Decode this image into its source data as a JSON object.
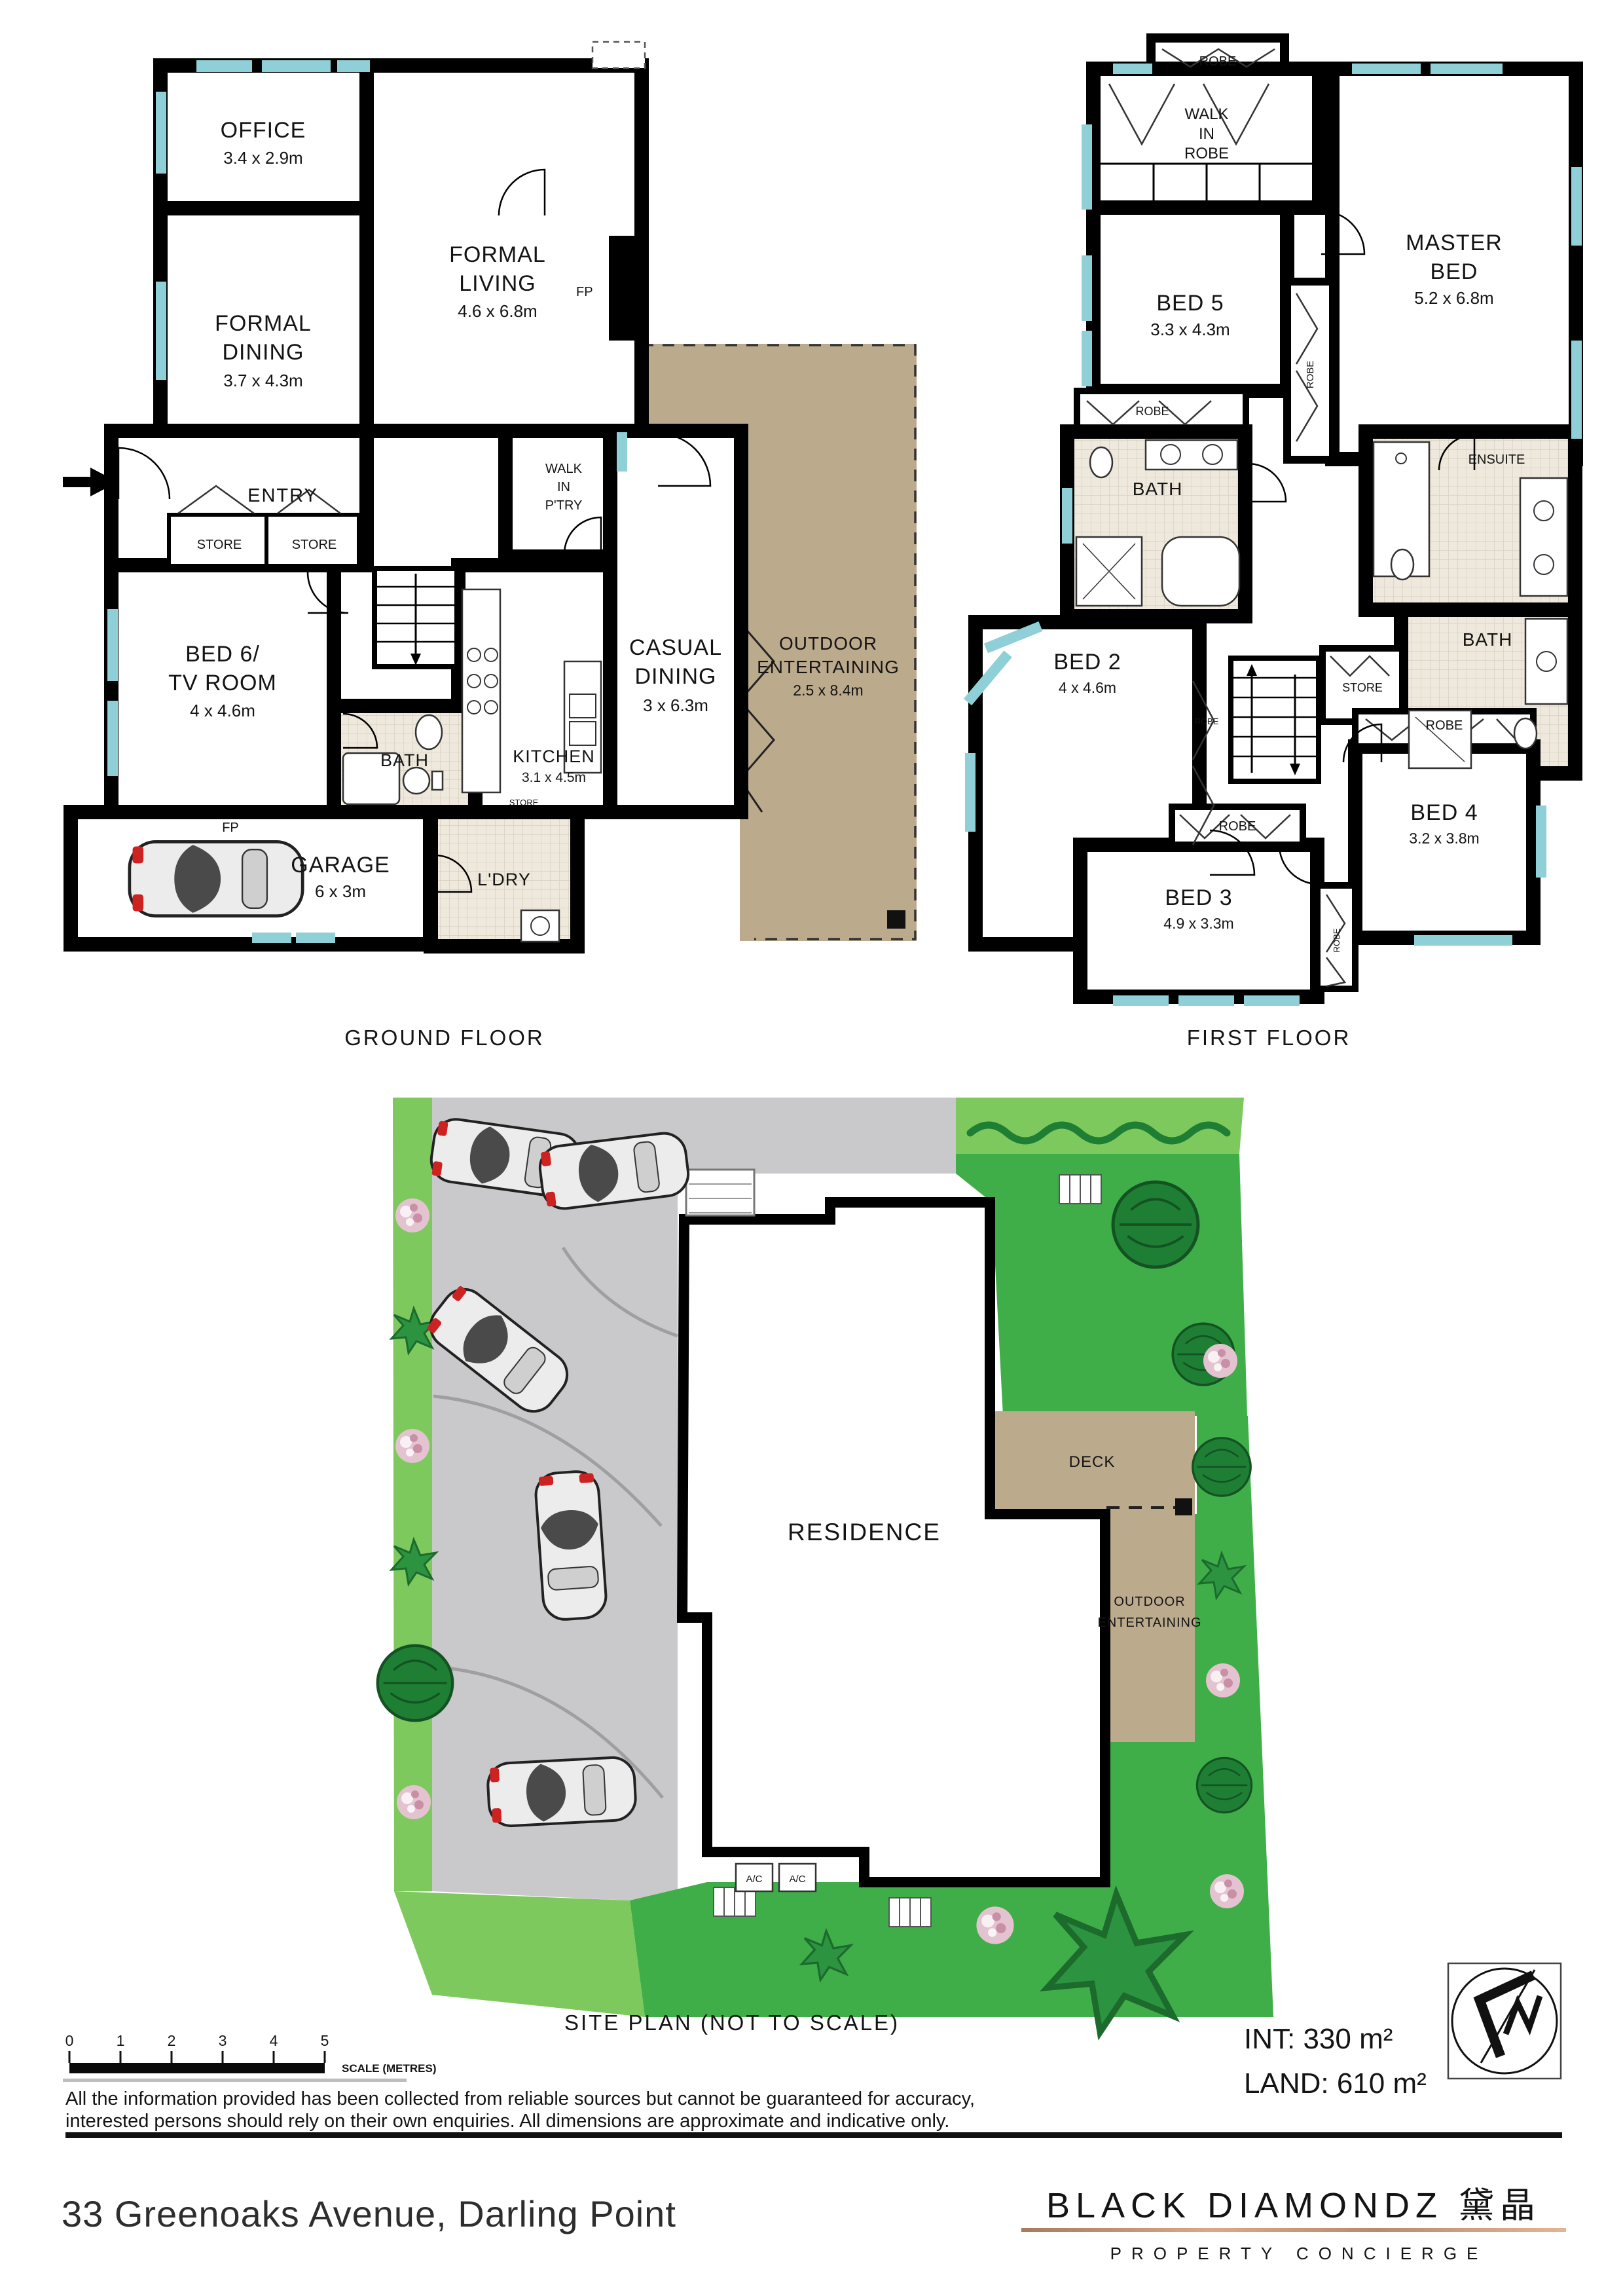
{
  "ground_floor": {
    "title": "GROUND FLOOR",
    "office": {
      "name": "OFFICE",
      "dims": "3.4 x 2.9m"
    },
    "formal_living": {
      "l1": "FORMAL",
      "l2": "LIVING",
      "dims": "4.6 x 6.8m"
    },
    "formal_dining": {
      "l1": "FORMAL",
      "l2": "DINING",
      "dims": "3.7 x 4.3m"
    },
    "entry": "ENTRY",
    "store_1": "STORE",
    "store_2": "STORE",
    "walk_in_pantry": {
      "l1": "WALK",
      "l2": "IN",
      "l3": "P'TRY"
    },
    "fp_living": "FP",
    "bed6": {
      "l1": "BED 6/",
      "l2": "TV ROOM",
      "dims": "4 x 4.6m"
    },
    "bath": "BATH",
    "kitchen": {
      "name": "KITCHEN",
      "dims": "3.1 x 4.5m"
    },
    "store_small": "STORE",
    "casual_dining": {
      "l1": "CASUAL",
      "l2": "DINING",
      "dims": "3 x 6.3m"
    },
    "outdoor": {
      "l1": "OUTDOOR",
      "l2": "ENTERTAINING",
      "dims": "2.5 x 8.4m"
    },
    "ldry": "L'DRY",
    "fp_garage": "FP",
    "garage": {
      "name": "GARAGE",
      "dims": "6 x 3m"
    }
  },
  "first_floor": {
    "title": "FIRST FLOOR",
    "robe_top": "ROBE",
    "wir": {
      "l1": "WALK",
      "l2": "IN",
      "l3": "ROBE"
    },
    "master_bed": {
      "l1": "MASTER",
      "l2": "BED",
      "dims": "5.2 x 6.8m"
    },
    "bed5": {
      "name": "BED 5",
      "dims": "3.3 x 4.3m"
    },
    "robe_master": "ROBE",
    "robe_bed5": "ROBE",
    "bath_left": "BATH",
    "ensuite": "ENSUITE",
    "bath_right": "BATH",
    "store": "STORE",
    "bed2": {
      "name": "BED 2",
      "dims": "4 x 4.6m"
    },
    "robe_bed2": "ROBE",
    "bed4": {
      "name": "BED 4",
      "dims": "3.2 x 3.8m"
    },
    "robe_bed4": "ROBE",
    "bed3": {
      "name": "BED 3",
      "dims": "4.9 x 3.3m"
    },
    "robe_bed3": "ROBE",
    "robe_bed3_side": "ROBE"
  },
  "site_plan": {
    "title": "SITE PLAN (NOT TO SCALE)",
    "residence": "RESIDENCE",
    "deck": "DECK",
    "outdoor": {
      "l1": "OUTDOOR",
      "l2": "ENTERTAINING"
    },
    "ac_1": "A/C",
    "ac_2": "A/C"
  },
  "scale_bar": {
    "ticks": [
      "0",
      "1",
      "2",
      "3",
      "4",
      "5"
    ],
    "label": "SCALE (METRES)"
  },
  "footer": {
    "disclaimer_l1": "All the information provided has been collected from reliable sources but cannot be guaranteed for accuracy,",
    "disclaimer_l2": "interested persons should rely on their own enquiries. All dimensions are approximate and indicative only.",
    "address": "33 Greenoaks Avenue, Darling Point",
    "area_int": "INT: 330 m²",
    "area_land": "LAND: 610 m²"
  },
  "logo": {
    "brand": "BLACK DIAMONDZ 黛晶",
    "tagline": "PROPERTY CONCIERGE"
  },
  "colors": {
    "wall": "#000000",
    "window": "#8ecfd8",
    "outdoor_tan": "#bcaa8d",
    "grass": "#3fae49",
    "grass_light": "#7dc95e",
    "paving": "#c9c9cb",
    "logo_gold": "#c28e71"
  }
}
